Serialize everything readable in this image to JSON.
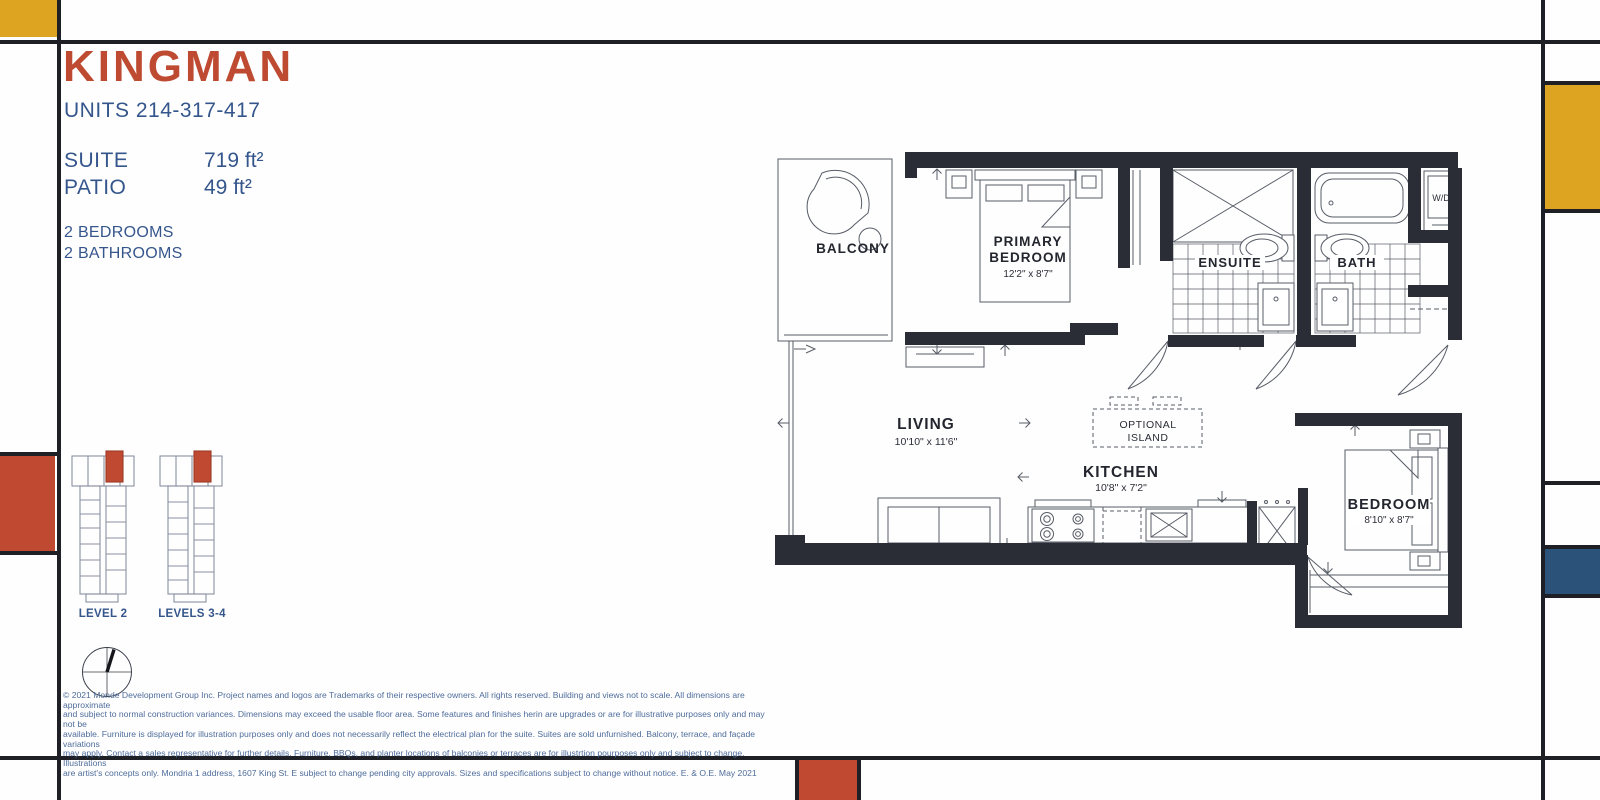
{
  "palette": {
    "line_black": "#1e2026",
    "mondrian_red": "#bf4a31",
    "mondrian_yellow": "#dca421",
    "mondrian_blue": "#2b5278",
    "title_red": "#be4a31",
    "text_blue": "#35568c",
    "wall_dark": "#2a2c36",
    "plan_line_gray": "#575c66"
  },
  "header": {
    "title": "KINGMAN",
    "units": "UNITS 214-317-417",
    "suite_label": "SUITE",
    "suite_value": "719 ft²",
    "patio_label": "PATIO",
    "patio_value": "49 ft²",
    "bedrooms": "2 BEDROOMS",
    "bathrooms": "2 BATHROOMS"
  },
  "keyplan": {
    "level2_label": "LEVEL 2",
    "levels34_label": "LEVELS 3-4"
  },
  "plan": {
    "balcony": "BALCONY",
    "primary_line1": "PRIMARY",
    "primary_line2": "BEDROOM",
    "primary_dims": "12'2\" x 8'7\"",
    "ensuite": "ENSUITE",
    "bath": "BATH",
    "wd": "W/D",
    "living": "LIVING",
    "living_dims": "10'10\" x 11'6\"",
    "island_line1": "OPTIONAL",
    "island_line2": "ISLAND",
    "kitchen": "KITCHEN",
    "kitchen_dims": "10'8\" x 7'2\"",
    "bedroom": "BEDROOM",
    "bedroom_dims": "8'10\" x 8'7\""
  },
  "disclaimer": {
    "line1": "© 2021 Monde Development Group Inc.  Project names and logos are Trademarks of their respective owners.  All rights reserved.  Building and views not to scale.  All dimensions are approximate",
    "line2": "and subject to normal construction variances.  Dimensions may exceed the usable floor area.  Some features and finishes herin are upgrades or are for illustrative purposes only and may not be",
    "line3": "available.  Furniture is displayed for illustration purposes only and does not necessarily reflect the electrical plan for the suite.  Suites are sold unfurnished.  Balcony, terrace, and façade variations",
    "line4": "may apply.  Contact a sales representative for further details.  Furniture, BBQs, and planter locations of balconies or terraces are for illustrtion pourposes only and subject to change.  Illustrations",
    "line5": "are artist's concepts only.  Mondria 1 address, 1607 King St. E subject to change pending city approvals.  Sizes and specifications subject to change without notice. E. & O.E. May 2021"
  }
}
